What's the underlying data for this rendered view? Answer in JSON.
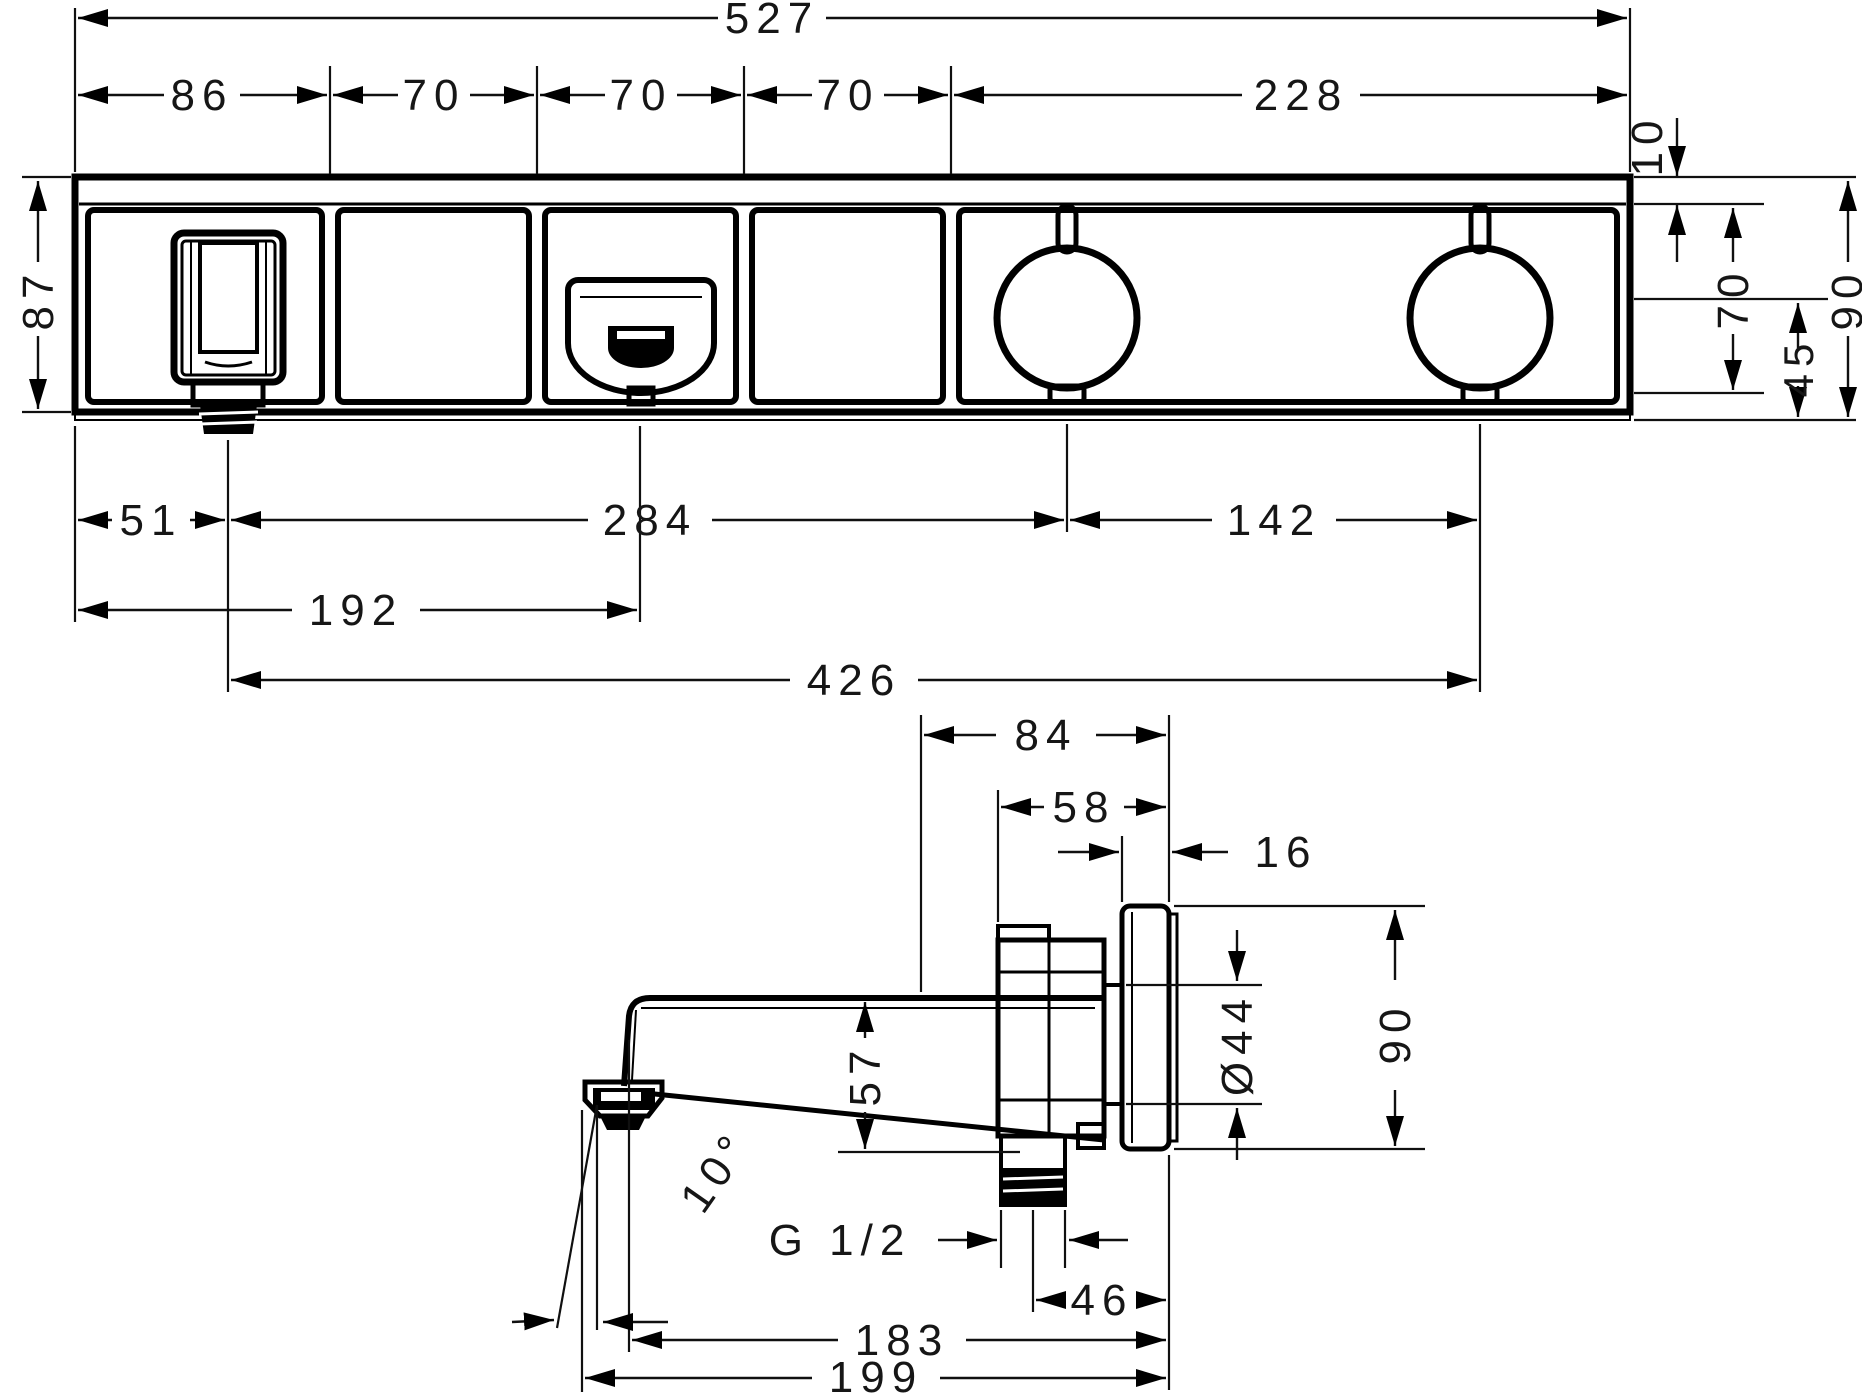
{
  "drawing": {
    "type": "technical-dimension-drawing",
    "line_color": "#000000",
    "background": "#ffffff",
    "views": {
      "front_view": {
        "overall_width_mm": "527",
        "top_segments_mm": [
          "86",
          "70",
          "70",
          "70",
          "228"
        ],
        "top_right_offset_mm": "10",
        "left_height_mm": "87",
        "right_heights_mm": [
          "70",
          "45",
          "90"
        ],
        "bottom_dims_mm": [
          "51",
          "284",
          "142",
          "192",
          "426"
        ]
      },
      "side_view": {
        "depth_dims_mm": [
          "84",
          "58",
          "16"
        ],
        "spout_height_mm": "57",
        "escutcheon_diameter": "Ø44",
        "escutcheon_height_mm": "90",
        "spout_angle": "10°",
        "thread_label": "G 1/2",
        "bottom_dims_mm": [
          "46",
          "183",
          "199"
        ]
      }
    }
  },
  "dims": {
    "d527": "527",
    "d86": "86",
    "d70a": "70",
    "d70b": "70",
    "d70c": "70",
    "d228": "228",
    "d10": "10",
    "d87": "87",
    "d70r": "70",
    "d45": "45",
    "d90r": "90",
    "d51": "51",
    "d284": "284",
    "d142": "142",
    "d192": "192",
    "d426": "426",
    "d84": "84",
    "d58": "58",
    "d16": "16",
    "d57": "57",
    "d44": "Ø44",
    "d90s": "90",
    "dangle": "10°",
    "dthread": "G 1/2",
    "d46": "46",
    "d183": "183",
    "d199": "199"
  }
}
